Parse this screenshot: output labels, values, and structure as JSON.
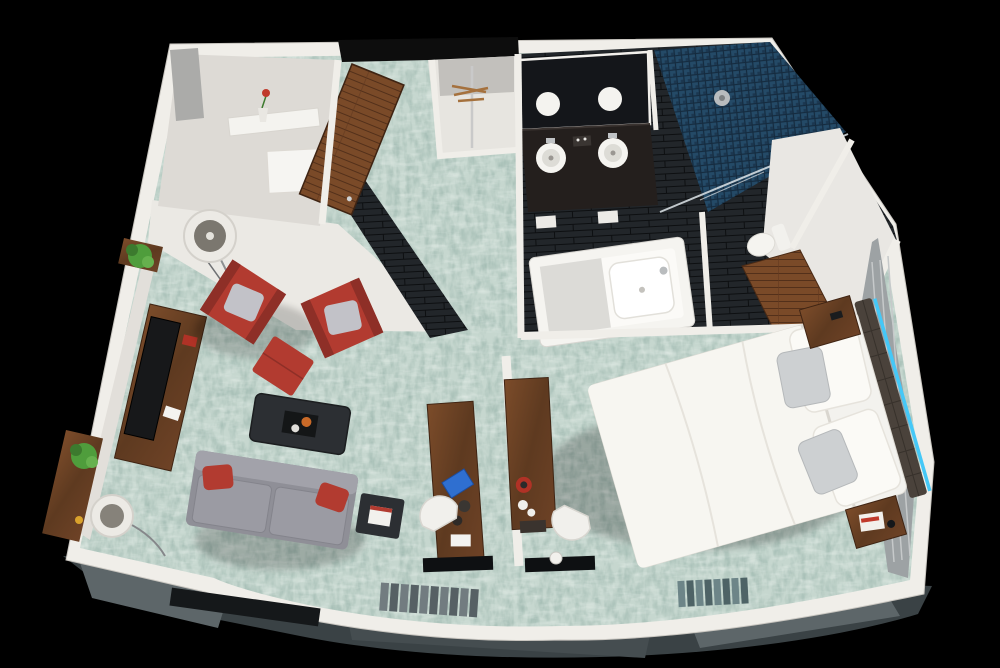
{
  "scene": {
    "title": "3D top-down rendering of a hotel suite floor plan on a black background",
    "view": "isometric top-down cutaway",
    "rooms": [
      {
        "name": "living-room",
        "floor": "seafoam patterned carpet",
        "objects": [
          "media-console",
          "flat-screen-tv",
          "gray-sofa",
          "red-throw-pillows",
          "red-accent-chair",
          "red-accent-chair",
          "red-ottoman",
          "gray-chair-pillows",
          "dark-coffee-table",
          "serving-tray",
          "dark-side-table",
          "book",
          "floor-lamp",
          "arc-floor-lamp",
          "potted-plant",
          "potted-plant",
          "wood-shelf"
        ]
      },
      {
        "name": "entry",
        "floor": "carpet with dark tile threshold",
        "objects": [
          "open-wood-entry-door",
          "closet-rod",
          "wood-hangers"
        ]
      },
      {
        "name": "kitchenette-nook",
        "floor": "white",
        "objects": [
          "counter-shelf",
          "rose-in-vase",
          "white-cabinet",
          "frosted-glass-panel"
        ]
      },
      {
        "name": "bathroom",
        "floor": "dark slate tile",
        "objects": [
          "double-vanity",
          "two-vessel-sinks",
          "mirror-with-reflections",
          "faucets",
          "towels",
          "blue-mosaic-walk-in-shower",
          "glass-shower-panel",
          "shower-head",
          "soaking-tub",
          "toilet",
          "wood-sliding-door"
        ]
      },
      {
        "name": "bedroom",
        "floor": "seafoam patterned carpet",
        "objects": [
          "king-bed",
          "white-duvet",
          "white-pillows",
          "gray-accent-pillows",
          "tufted-dark-headboard",
          "blue-led-accent-strip",
          "wood-nightstand",
          "wood-nightstand",
          "magazine",
          "paneled-accent-wall",
          "work-desk",
          "coffee-maker",
          "cups",
          "desk-chair",
          "floor-mat",
          "kettle"
        ]
      },
      {
        "name": "work-alcove",
        "floor": "carpet",
        "objects": [
          "wood-desk",
          "blue-tablet",
          "desk-chair",
          "floor-mat",
          "divider-wall"
        ]
      }
    ],
    "window_wall": "curved floor-to-ceiling glazing along the bottom edge with gray curtain panels"
  },
  "colors": {
    "background": "#000000",
    "wall_white": "#f0eee9",
    "wall_face": "#ebe9e4",
    "wall_face_side": "#e2dfda",
    "carpet_base": "#c6d7cf",
    "carpet_speckle": "#54786b",
    "tile_dark": "#22262a",
    "grout": "#0d0f11",
    "mosaic_blue": "#244a67",
    "wood": "#6e4226",
    "wood_dark": "#4a2a15",
    "sofa_gray": "#8f8f97",
    "cushion_gray": "#9b9ba3",
    "chair_red": "#b23b30",
    "pillow_gray": "#c2c2c8",
    "table_dark": "#2c2f33",
    "bed_white": "#f3f2ee",
    "duvet_white": "#f7f6f1",
    "pillow_white": "#fbfaf6",
    "accent_pillow_gray": "#cdd0d2",
    "headboard_brown": "#4a423b",
    "led_blue": "#45c8f7",
    "fixture_white": "#f5f4f0",
    "counter_black": "#241f1d",
    "mirror_dark": "#14161a",
    "panel_gray": "#9da2a4",
    "glass_gray": "#5d6669",
    "glass_dark": "#454d50",
    "curtain_gray": "#727c80",
    "curtain_teal": "#6d8588",
    "plant_green": "#4f9d3c",
    "metal_silver": "#c0c3c5",
    "kitchenette_floor": "#dddad5",
    "toilet_room_floor": "#e9e7e3"
  }
}
